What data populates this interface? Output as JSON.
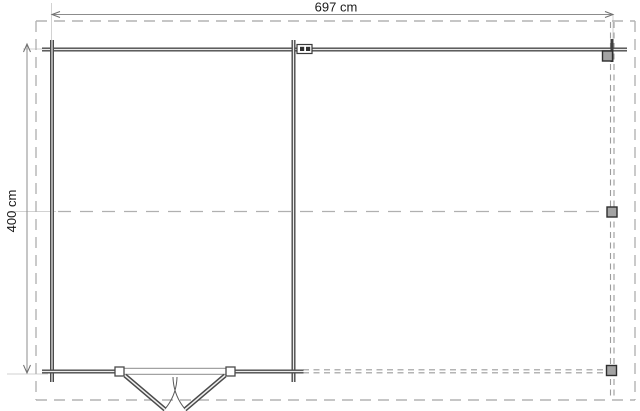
{
  "drawing": {
    "type": "floor-plan",
    "description": "log cabin with side canopy, top view",
    "dimensions": {
      "width_label": "697 cm",
      "depth_label": "400 cm",
      "width_value_cm": 697,
      "depth_value_cm": 400,
      "unit": "cm"
    },
    "elements": {
      "cabin": "enclosed room with solid log walls, left side",
      "canopy": "open annex outlined with dashed lines and three posts, right side",
      "door": "double outward-swinging door centered in cabin bottom wall",
      "posts_count": 3
    },
    "colors": {
      "background": "#ffffff",
      "wall": "#4a4a4a",
      "wall_core": "#ececec",
      "dashed_outline": "#b3b3b3",
      "post_dash_line": "#9c9c9c",
      "dimension_line": "#8c8c8c",
      "extension_line": "#d2d2d2",
      "post_fill": "#a3a3a3",
      "post_border": "#2e2e2e",
      "text": "#1a1a1a"
    }
  }
}
